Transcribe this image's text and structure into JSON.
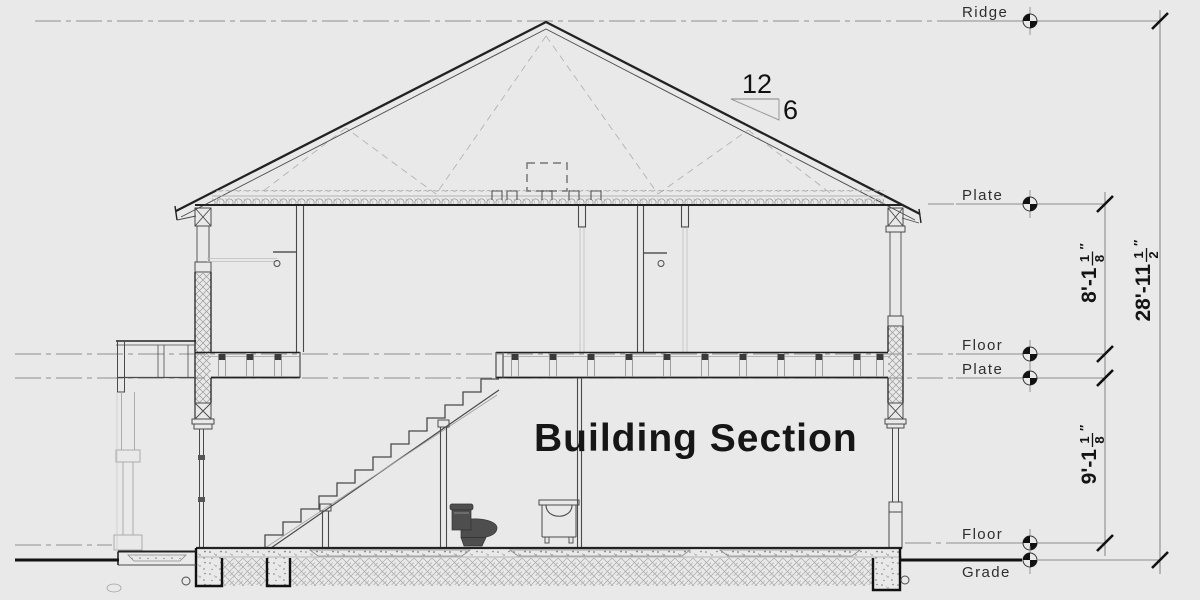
{
  "drawing": {
    "title": "Building Section",
    "roof_pitch": {
      "run": "12",
      "rise": "6"
    },
    "levels": [
      "Ridge",
      "Plate",
      "Floor",
      "Plate",
      "Floor",
      "Grade"
    ],
    "dimensions": {
      "upper_floor_height": {
        "value": "8'-1 1/8\"",
        "whole": "8'-1",
        "frac_num": "1",
        "frac_den": "8",
        "unit_mark": "″"
      },
      "overall_height": {
        "value": "28'-11 1/2\"",
        "whole": "28'-11",
        "frac_num": "1",
        "frac_den": "2",
        "unit_mark": "″"
      },
      "main_floor_height": {
        "value": "9'-1 1/8\"",
        "whole": "9'-1",
        "frac_num": "1",
        "frac_den": "8",
        "unit_mark": "″"
      }
    }
  }
}
